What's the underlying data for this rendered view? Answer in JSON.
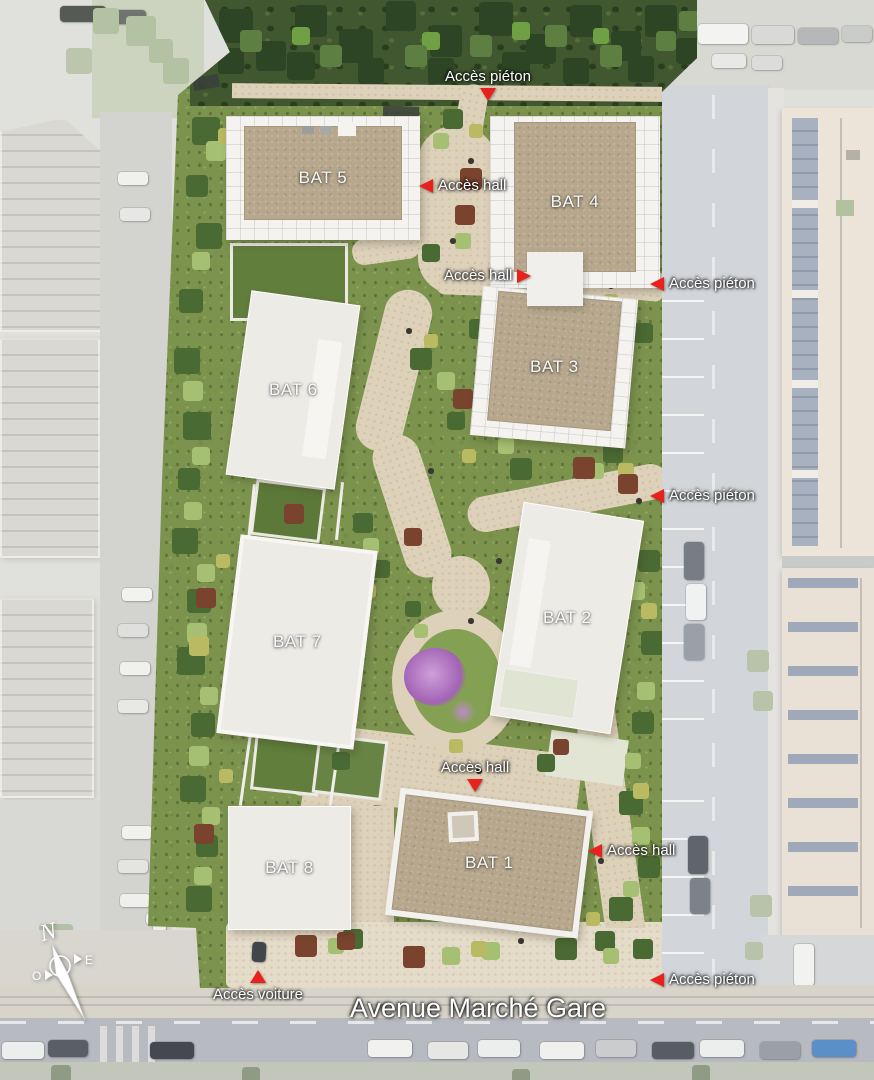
{
  "plan": {
    "buildings": [
      {
        "id": "bat-5",
        "label": "BAT 5"
      },
      {
        "id": "bat-4",
        "label": "BAT 4"
      },
      {
        "id": "bat-3",
        "label": "BAT 3"
      },
      {
        "id": "bat-6",
        "label": "BAT 6"
      },
      {
        "id": "bat-7",
        "label": "BAT 7"
      },
      {
        "id": "bat-2",
        "label": "BAT 2"
      },
      {
        "id": "bat-8",
        "label": "BAT 8"
      },
      {
        "id": "bat-1",
        "label": "BAT 1"
      }
    ],
    "access_points": [
      {
        "id": "acces-pieton-nord",
        "label": "Accès piéton",
        "arrow": "down"
      },
      {
        "id": "acces-hall-bat4",
        "label": "Accès hall",
        "arrow": "left"
      },
      {
        "id": "acces-hall-central",
        "label": "Accès hall",
        "arrow": "right"
      },
      {
        "id": "acces-pieton-est-haut",
        "label": "Accès piéton",
        "arrow": "left"
      },
      {
        "id": "acces-pieton-est-milieu",
        "label": "Accès piéton",
        "arrow": "left"
      },
      {
        "id": "acces-hall-bat1-nord",
        "label": "Accès hall",
        "arrow": "down"
      },
      {
        "id": "acces-hall-bat1-est",
        "label": "Accès hall",
        "arrow": "left"
      },
      {
        "id": "acces-voiture",
        "label": "Accès voiture",
        "arrow": "up"
      },
      {
        "id": "acces-pieton-sud-est",
        "label": "Accès piéton",
        "arrow": "left"
      }
    ],
    "street_name": "Avenue Marché Gare",
    "compass": {
      "north": "N",
      "east": "E",
      "west": "O"
    },
    "colors": {
      "marker_red": "#e8211c",
      "roof_brown": "#b6a78d",
      "building_white": "#edebe6",
      "path_beige": "#ddd1ba",
      "site_green": "#7c934e"
    }
  }
}
